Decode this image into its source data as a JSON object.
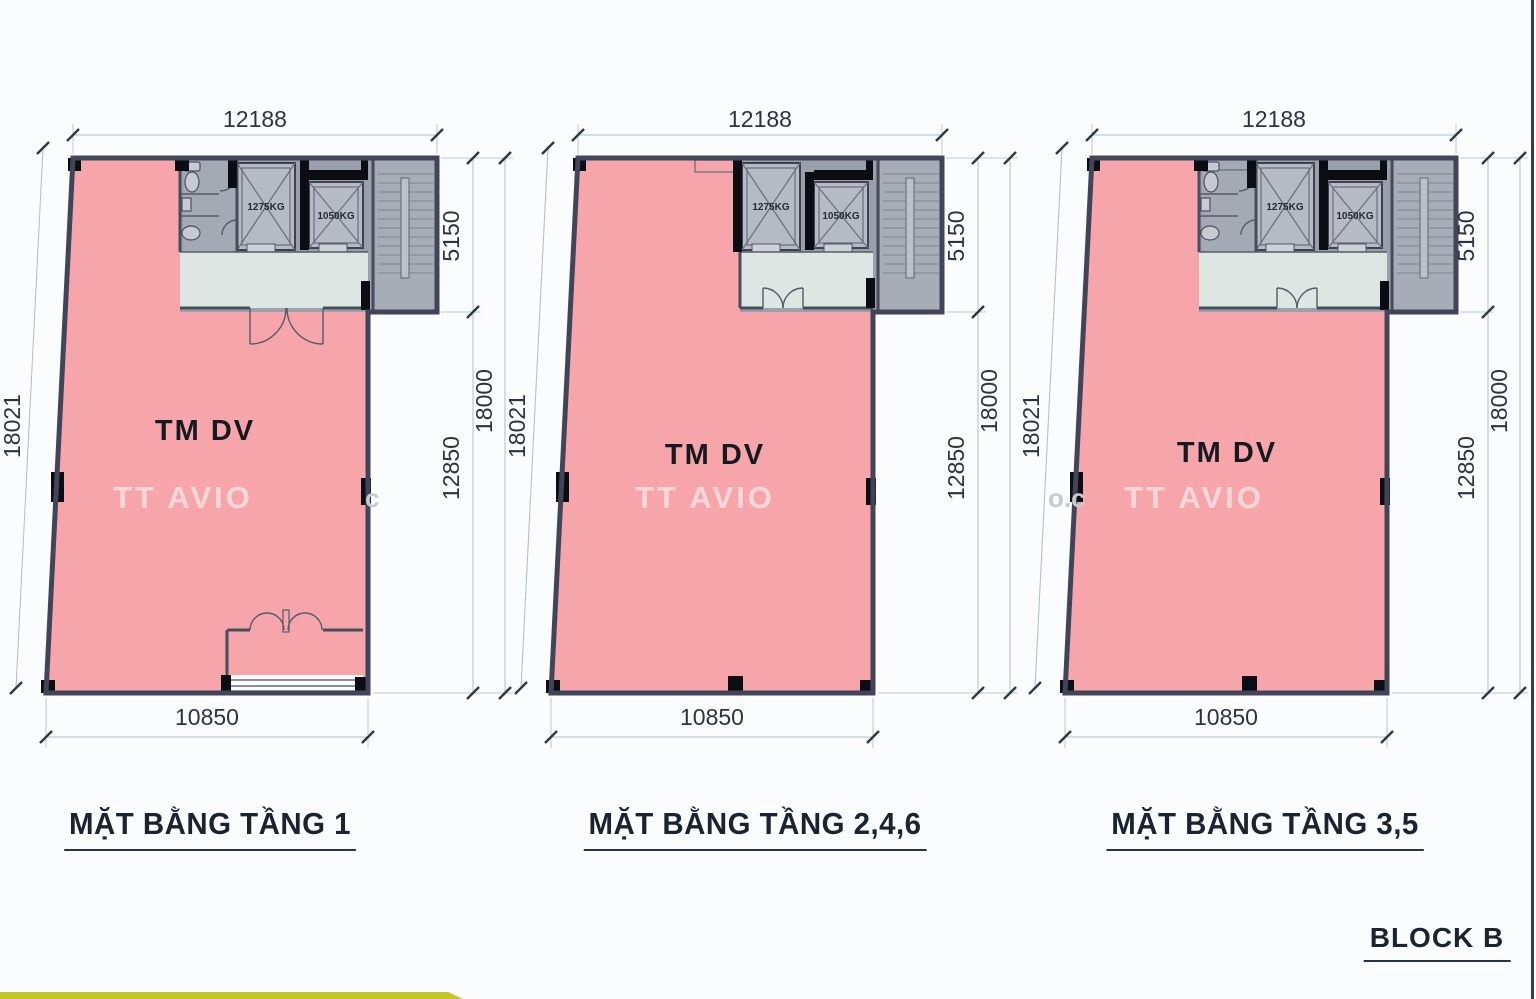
{
  "page": {
    "background": "#fbfcfd",
    "right_border_color": "#3a3e48",
    "bottom_bar_color": "#c3c52a"
  },
  "block_label": "BLOCK B",
  "watermark": {
    "brand": "TT AVIO",
    "fragment_left": "c",
    "fragment_mid": "o.c"
  },
  "colors": {
    "room_pink": "#f6a6ab",
    "wall": "#42455a",
    "core_gray": "#9aa0ab",
    "lobby": "#dde6e2",
    "stair_gray": "#a7adb7",
    "dim_text": "#2b3342"
  },
  "plans": [
    {
      "title": "MẶT BẰNG TẦNG 1",
      "room_label": "TM DV",
      "elevators": [
        {
          "label": "1275KG"
        },
        {
          "label": "1050KG"
        }
      ],
      "dims": {
        "top": "12188",
        "left": "18021",
        "right_upper": "5150",
        "right_outer": "18000",
        "right_lower": "12850",
        "bottom": "10850"
      }
    },
    {
      "title": "MẶT BẰNG TẦNG 2,4,6",
      "room_label": "TM DV",
      "elevators": [
        {
          "label": "1275KG"
        },
        {
          "label": "1050KG"
        }
      ],
      "dims": {
        "top": "12188",
        "left": "18021",
        "right_upper": "5150",
        "right_outer": "18000",
        "right_lower": "12850",
        "bottom": "10850"
      }
    },
    {
      "title": "MẶT BẰNG TẦNG 3,5",
      "room_label": "TM DV",
      "elevators": [
        {
          "label": "1275KG"
        },
        {
          "label": "1050KG"
        }
      ],
      "dims": {
        "top": "12188",
        "left": "18021",
        "right_upper": "5150",
        "right_outer": "18000",
        "right_lower": "12850",
        "bottom": "10850"
      }
    }
  ]
}
